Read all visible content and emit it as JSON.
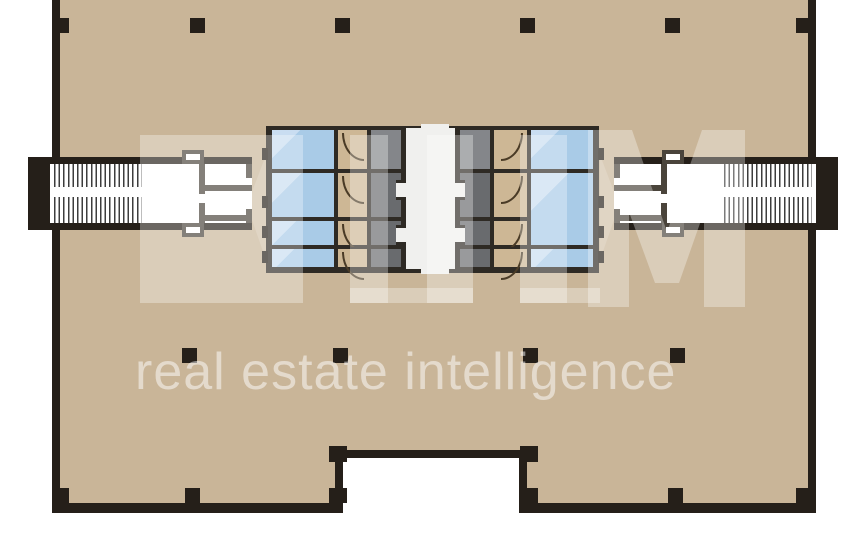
{
  "document": {
    "type": "floor-plan",
    "description": "Office building typical floor plan with central core, two external scissor stairs and open tan floor plate"
  },
  "watermark": {
    "logo_text": "ILM",
    "tagline": "real estate intelligence"
  },
  "colors": {
    "floor": "#c9b598",
    "wall": "#251f19",
    "corewall": "#2e2a24",
    "blue": "#a9cbe7",
    "blue_hi": "#c9ddf1",
    "wc": "#cdb795",
    "arc": "#4a3b26",
    "gray": "#84868a",
    "gray_dark": "#696b6e",
    "corridor": "#f0f0ee",
    "vest": "#4a443b",
    "outside": "#ffffff"
  },
  "plan": {
    "columns": [
      {
        "x": 57,
        "y": 18,
        "w": 12,
        "h": 15
      },
      {
        "x": 190,
        "y": 18,
        "w": 15,
        "h": 15
      },
      {
        "x": 335,
        "y": 18,
        "w": 15,
        "h": 15
      },
      {
        "x": 520,
        "y": 18,
        "w": 15,
        "h": 15
      },
      {
        "x": 665,
        "y": 18,
        "w": 15,
        "h": 15
      },
      {
        "x": 796,
        "y": 18,
        "w": 12,
        "h": 15
      },
      {
        "x": 182,
        "y": 348,
        "w": 15,
        "h": 15
      },
      {
        "x": 333,
        "y": 348,
        "w": 15,
        "h": 15
      },
      {
        "x": 523,
        "y": 348,
        "w": 15,
        "h": 15
      },
      {
        "x": 670,
        "y": 348,
        "w": 15,
        "h": 15
      },
      {
        "x": 57,
        "y": 488,
        "w": 12,
        "h": 15
      },
      {
        "x": 185,
        "y": 488,
        "w": 15,
        "h": 15
      },
      {
        "x": 668,
        "y": 488,
        "w": 15,
        "h": 15
      },
      {
        "x": 796,
        "y": 488,
        "w": 12,
        "h": 15
      },
      {
        "x": 329,
        "y": 446,
        "w": 18,
        "h": 16
      },
      {
        "x": 520,
        "y": 446,
        "w": 18,
        "h": 16
      },
      {
        "x": 329,
        "y": 488,
        "w": 18,
        "h": 15
      },
      {
        "x": 520,
        "y": 488,
        "w": 18,
        "h": 15
      }
    ],
    "core_banks": [
      {
        "side": "left",
        "x": 270,
        "w": 66,
        "type": "elevator",
        "rows": [
          [
            128,
            43
          ],
          [
            171,
            48
          ],
          [
            219,
            28
          ],
          [
            247,
            22
          ]
        ]
      },
      {
        "side": "left",
        "x": 336,
        "w": 33,
        "type": "wc",
        "rows": [
          [
            128,
            43
          ],
          [
            171,
            48
          ],
          [
            219,
            28
          ],
          [
            247,
            22
          ]
        ]
      },
      {
        "side": "left",
        "x": 369,
        "w": 34,
        "type": "service",
        "rows": [
          [
            128,
            43
          ],
          [
            171,
            48
          ],
          [
            219,
            28
          ],
          [
            247,
            22
          ]
        ]
      },
      {
        "side": "right",
        "x": 458,
        "w": 34,
        "type": "service",
        "rows": [
          [
            128,
            43
          ],
          [
            171,
            48
          ],
          [
            219,
            28
          ],
          [
            247,
            22
          ]
        ]
      },
      {
        "side": "right",
        "x": 492,
        "w": 37,
        "type": "wc",
        "rows": [
          [
            128,
            43
          ],
          [
            171,
            48
          ],
          [
            219,
            28
          ],
          [
            247,
            22
          ]
        ]
      },
      {
        "side": "right",
        "x": 529,
        "w": 66,
        "type": "elevator",
        "rows": [
          [
            128,
            43
          ],
          [
            171,
            76
          ],
          [
            247,
            22
          ]
        ]
      }
    ],
    "door_ticks": [
      {
        "x": 262,
        "y": 148
      },
      {
        "x": 262,
        "y": 196
      },
      {
        "x": 262,
        "y": 226
      },
      {
        "x": 262,
        "y": 251
      },
      {
        "x": 598,
        "y": 148
      },
      {
        "x": 598,
        "y": 196
      },
      {
        "x": 598,
        "y": 226
      },
      {
        "x": 598,
        "y": 251
      }
    ],
    "vestibule_walls": [
      {
        "x": 199,
        "y": 164,
        "w": 6,
        "h": 30
      },
      {
        "x": 205,
        "y": 185,
        "w": 47,
        "h": 6
      },
      {
        "x": 199,
        "y": 203,
        "w": 6,
        "h": 20
      },
      {
        "x": 205,
        "y": 215,
        "w": 47,
        "h": 6
      },
      {
        "x": 246,
        "y": 164,
        "w": 6,
        "h": 14
      },
      {
        "x": 246,
        "y": 209,
        "w": 6,
        "h": 14
      },
      {
        "x": 661,
        "y": 164,
        "w": 6,
        "h": 30
      },
      {
        "x": 614,
        "y": 185,
        "w": 47,
        "h": 6
      },
      {
        "x": 661,
        "y": 203,
        "w": 6,
        "h": 20
      },
      {
        "x": 614,
        "y": 215,
        "w": 47,
        "h": 6
      },
      {
        "x": 614,
        "y": 164,
        "w": 6,
        "h": 14
      },
      {
        "x": 614,
        "y": 209,
        "w": 6,
        "h": 14
      }
    ],
    "vestibule_bumps": [
      {
        "x": 182,
        "y": 150,
        "w": 22,
        "h": 14
      },
      {
        "x": 182,
        "y": 223,
        "w": 22,
        "h": 14
      },
      {
        "x": 662,
        "y": 150,
        "w": 22,
        "h": 14
      },
      {
        "x": 662,
        "y": 223,
        "w": 22,
        "h": 14
      }
    ]
  }
}
